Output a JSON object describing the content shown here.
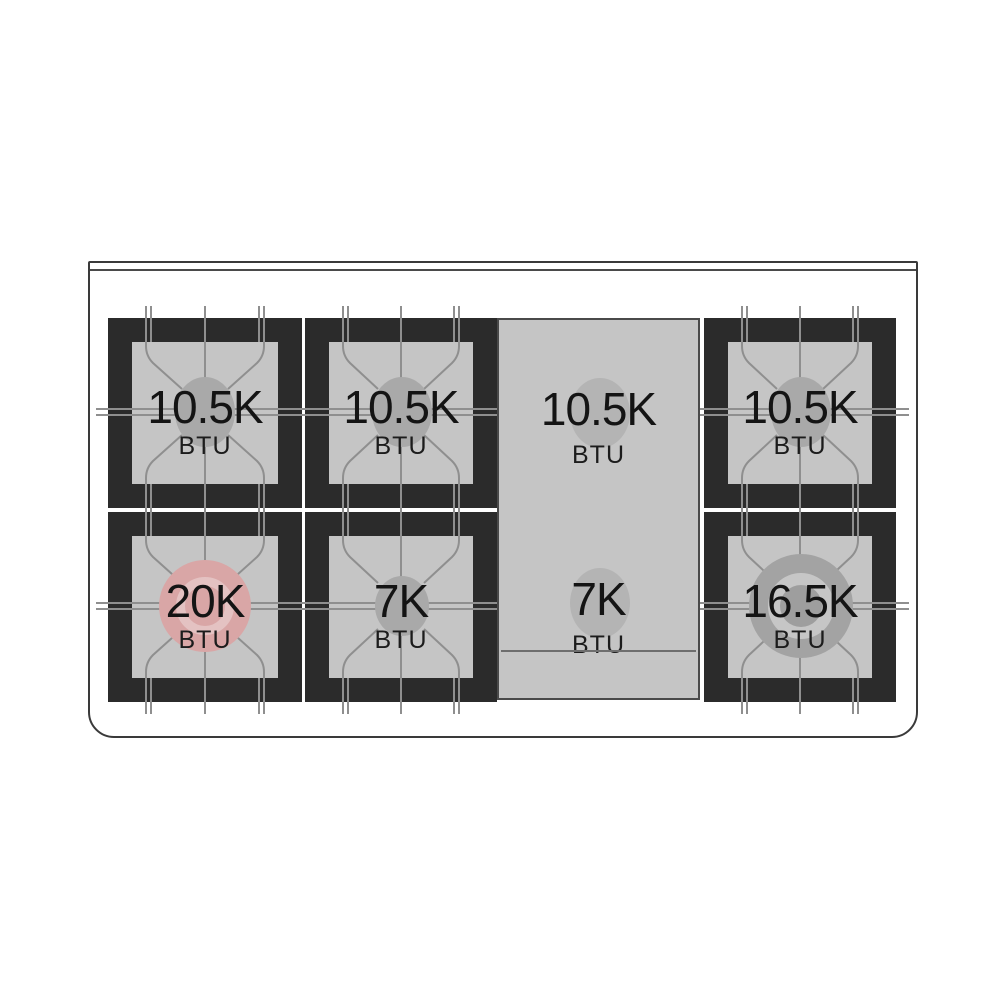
{
  "cooktop": {
    "burners": [
      {
        "id": "top-left",
        "value": "10.5K",
        "unit": "BTU",
        "type": "standard"
      },
      {
        "id": "top-center",
        "value": "10.5K",
        "unit": "BTU",
        "type": "standard"
      },
      {
        "id": "griddle-top",
        "value": "10.5K",
        "unit": "BTU",
        "type": "griddle"
      },
      {
        "id": "top-right",
        "value": "10.5K",
        "unit": "BTU",
        "type": "standard"
      },
      {
        "id": "bottom-left",
        "value": "20K",
        "unit": "BTU",
        "type": "high-power"
      },
      {
        "id": "bottom-center",
        "value": "7K",
        "unit": "BTU",
        "type": "simmer"
      },
      {
        "id": "griddle-bottom",
        "value": "7K",
        "unit": "BTU",
        "type": "griddle"
      },
      {
        "id": "bottom-right",
        "value": "16.5K",
        "unit": "BTU",
        "type": "dual-ring"
      }
    ],
    "colors": {
      "grate_frame": "#2b2b2b",
      "burner_surface": "#c5c5c5",
      "outline": "#3a3a3a",
      "grate_line": "#8f8f8f",
      "burner_cap": "#a9a9a9",
      "high_power_accent": "#d9a6a6",
      "text": "#141414"
    }
  }
}
